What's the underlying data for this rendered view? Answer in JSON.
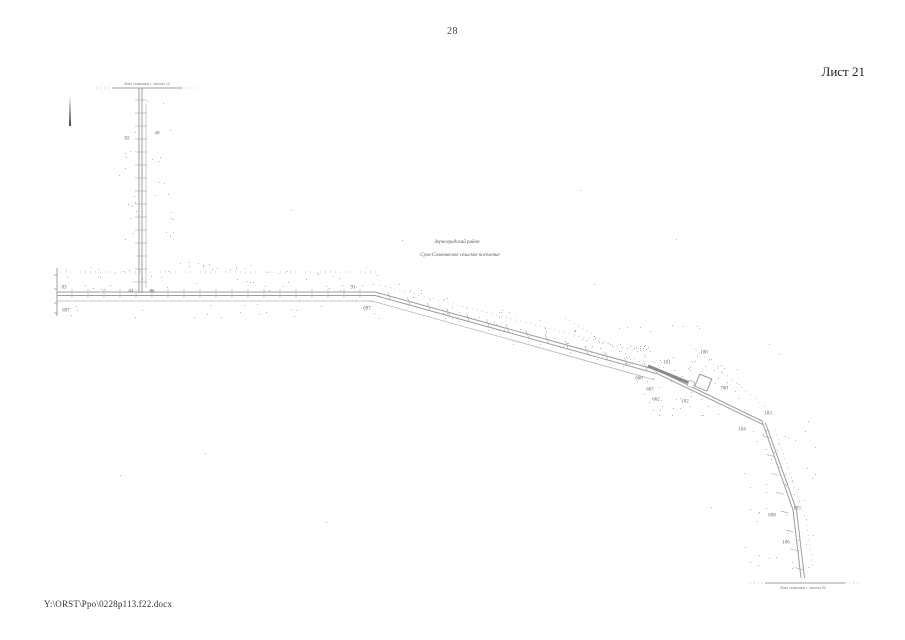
{
  "page": {
    "number": "28",
    "sheet_label": "Лист 21",
    "file_path": "Y:\\ORST\\Ppo\\0228p113.f22.docx"
  },
  "map": {
    "region_label_line1": "Зерноградский район",
    "region_label_line2": "Сухо-Соленовское сельское поселение",
    "top_edge_label": "Зона стыковки с листом 12",
    "bottom_edge_label": "Зона стыковки с листом 22",
    "point_labels": [
      {
        "text": "82",
        "x": 127,
        "y": 139
      },
      {
        "text": "49",
        "x": 157,
        "y": 134
      },
      {
        "text": "83",
        "x": 64,
        "y": 288
      },
      {
        "text": "84",
        "x": 131,
        "y": 292
      },
      {
        "text": "86",
        "x": 152,
        "y": 292
      },
      {
        "text": "697",
        "x": 66,
        "y": 311
      },
      {
        "text": "91",
        "x": 353,
        "y": 288
      },
      {
        "text": "697",
        "x": 367,
        "y": 309
      },
      {
        "text": "100",
        "x": 704,
        "y": 353
      },
      {
        "text": "101",
        "x": 667,
        "y": 363
      },
      {
        "text": "660",
        "x": 639,
        "y": 379
      },
      {
        "text": "667",
        "x": 650,
        "y": 390
      },
      {
        "text": "662",
        "x": 656,
        "y": 400
      },
      {
        "text": "102",
        "x": 685,
        "y": 402
      },
      {
        "text": "700",
        "x": 724,
        "y": 389
      },
      {
        "text": "103",
        "x": 768,
        "y": 414
      },
      {
        "text": "104",
        "x": 742,
        "y": 430
      },
      {
        "text": "698",
        "x": 772,
        "y": 516
      },
      {
        "text": "105",
        "x": 797,
        "y": 509
      },
      {
        "text": "106",
        "x": 786,
        "y": 543
      }
    ]
  }
}
